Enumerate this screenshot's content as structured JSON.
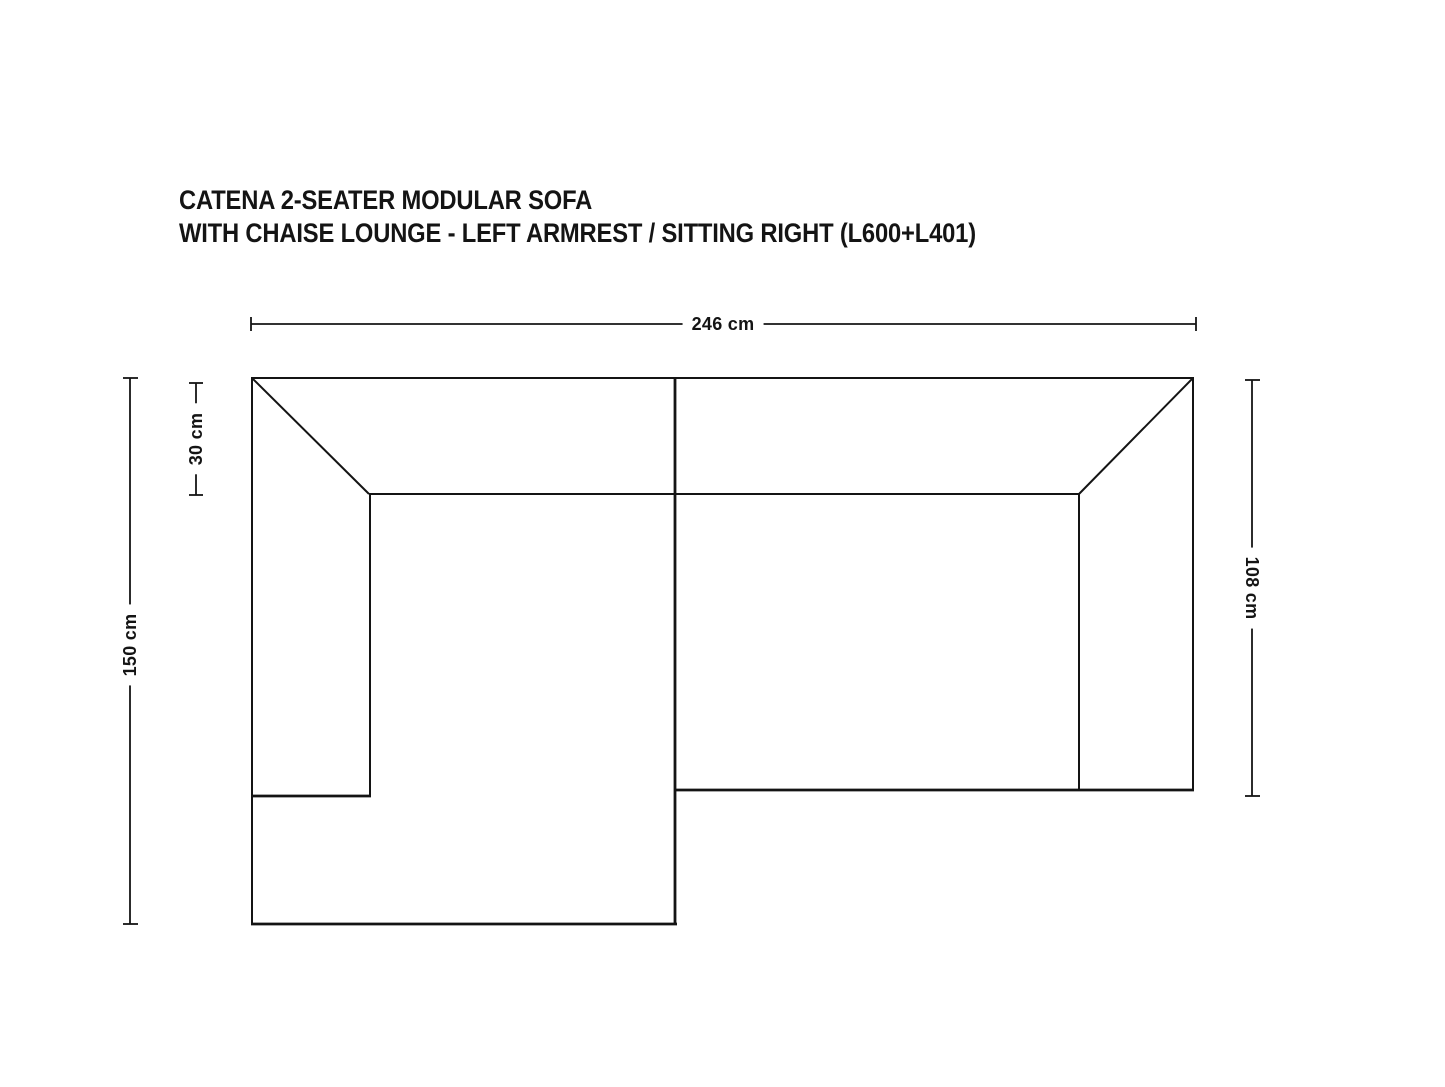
{
  "title": {
    "line1": "CATENA 2-SEATER MODULAR SOFA",
    "line2": "WITH CHAISE LOUNGE - LEFT ARMREST / SITTING RIGHT (L600+L401)"
  },
  "dimensions": {
    "overall_width": "246 cm",
    "overall_depth": "150 cm",
    "backrest_depth": "30 cm",
    "right_module_depth": "108 cm"
  },
  "colors": {
    "line": "#141414",
    "background": "#ffffff",
    "text": "#141414"
  }
}
